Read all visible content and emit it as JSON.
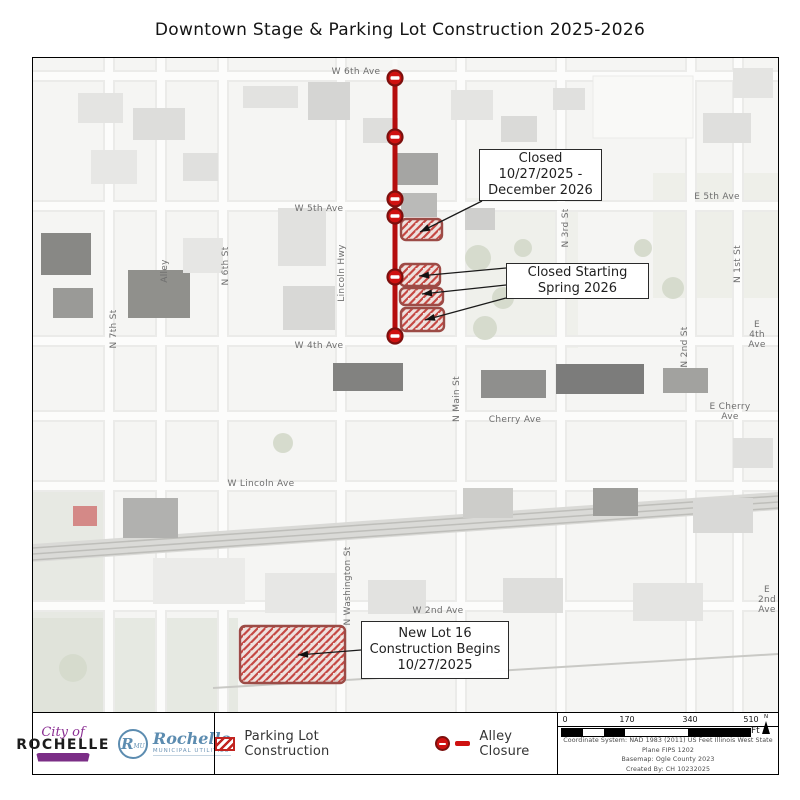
{
  "title": "Downtown Stage & Parking Lot Construction 2025-2026",
  "map": {
    "streets": [
      {
        "text": "W 6th Ave",
        "x": 323,
        "y": 14,
        "rot": 0
      },
      {
        "text": "W 5th Ave",
        "x": 286,
        "y": 151,
        "rot": 0
      },
      {
        "text": "E 5th Ave",
        "x": 684,
        "y": 139,
        "rot": 0
      },
      {
        "text": "W 4th Ave",
        "x": 286,
        "y": 288,
        "rot": 0
      },
      {
        "text": "E 4th Ave",
        "x": 724,
        "y": 277,
        "rot": 0
      },
      {
        "text": "Cherry Ave",
        "x": 482,
        "y": 362,
        "rot": 0
      },
      {
        "text": "E Cherry Ave",
        "x": 697,
        "y": 354,
        "rot": 0
      },
      {
        "text": "W Lincoln Ave",
        "x": 228,
        "y": 426,
        "rot": 0
      },
      {
        "text": "W 2nd Ave",
        "x": 405,
        "y": 553,
        "rot": 0
      },
      {
        "text": "E 2nd\nAve",
        "x": 734,
        "y": 542,
        "rot": 0
      },
      {
        "text": "N 7th St",
        "x": 81,
        "y": 271,
        "rot": 1
      },
      {
        "text": "Alley",
        "x": 132,
        "y": 213,
        "rot": 1
      },
      {
        "text": "N 6th St",
        "x": 193,
        "y": 208,
        "rot": 1
      },
      {
        "text": "Lincoln Hwy",
        "x": 309,
        "y": 215,
        "rot": 1
      },
      {
        "text": "N Main St",
        "x": 424,
        "y": 341,
        "rot": 1
      },
      {
        "text": "N 3rd St",
        "x": 533,
        "y": 170,
        "rot": 1
      },
      {
        "text": "N 1st St",
        "x": 705,
        "y": 206,
        "rot": 1
      },
      {
        "text": "N 2nd St",
        "x": 652,
        "y": 289,
        "rot": 1
      },
      {
        "text": "N Washington St",
        "x": 315,
        "y": 528,
        "rot": 1
      }
    ],
    "parking_lots": [
      {
        "x": 368,
        "y": 161,
        "w": 41,
        "h": 21
      },
      {
        "x": 367,
        "y": 206,
        "w": 40,
        "h": 22
      },
      {
        "x": 367,
        "y": 230,
        "w": 43,
        "h": 17
      },
      {
        "x": 368,
        "y": 250,
        "w": 43,
        "h": 23
      },
      {
        "x": 207,
        "y": 568,
        "w": 105,
        "h": 57
      }
    ],
    "alley_closure": {
      "x": 362,
      "y1": 20,
      "y2": 278,
      "circles": [
        20,
        79,
        141,
        158,
        219,
        278
      ]
    },
    "callouts": [
      {
        "lines": [
          "Closed",
          "10/27/2025 -",
          "December 2026"
        ],
        "x": 446,
        "y": 91,
        "w": 123,
        "h": 52,
        "leaders": [
          [
            449,
            143,
            387,
            174
          ]
        ]
      },
      {
        "lines": [
          "Closed Starting",
          "Spring 2026"
        ],
        "x": 473,
        "y": 205,
        "w": 143,
        "h": 36,
        "leaders": [
          [
            473,
            210,
            386,
            218
          ],
          [
            473,
            227,
            389,
            236
          ],
          [
            473,
            240,
            392,
            262
          ]
        ]
      },
      {
        "lines": [
          "New Lot 16",
          "Construction Begins",
          "10/27/2025"
        ],
        "x": 328,
        "y": 563,
        "w": 148,
        "h": 58,
        "leaders": [
          [
            328,
            592,
            265,
            597
          ]
        ]
      }
    ]
  },
  "legend": {
    "items": [
      {
        "label": "Parking Lot Construction",
        "icon": "parking-hatch-swatch"
      },
      {
        "label": "Alley Closure",
        "icon": "no-entry-icon"
      }
    ]
  },
  "scalebar": {
    "ticks": [
      {
        "label": "0",
        "x": 4
      },
      {
        "label": "170",
        "x": 66
      },
      {
        "label": "340",
        "x": 129
      },
      {
        "label": "510",
        "x": 190
      }
    ],
    "unit": "Ft",
    "north_label": "N",
    "segments": [
      {
        "w": 21,
        "f": "#000000"
      },
      {
        "w": 21,
        "f": "#ffffff"
      },
      {
        "w": 21,
        "f": "#000000"
      },
      {
        "w": 63,
        "f": "#ffffff"
      },
      {
        "w": 62,
        "f": "#000000"
      }
    ]
  },
  "credits": {
    "line1": "Projection: Transverse Mercator",
    "line2": "Coordinate System: NAD 1983 (2011) US Feet Illinois West State Plane FIPS 1202",
    "line3": "Basemap:  Ogle County 2023",
    "line4": "Created By: CH 10232025"
  },
  "logos": {
    "city": {
      "top": "City of",
      "name": "ROCHELLE"
    },
    "rmu": {
      "initial": "R",
      "sub": "MU",
      "name": "Rochelle",
      "tagline": "MUNICIPAL UTILITIES"
    }
  },
  "colors": {
    "closure_red": "#b50d0d",
    "no_entry_fill": "#cf1110",
    "lot_border": "#9c4b46",
    "hatch_red": "#bf2e27"
  }
}
